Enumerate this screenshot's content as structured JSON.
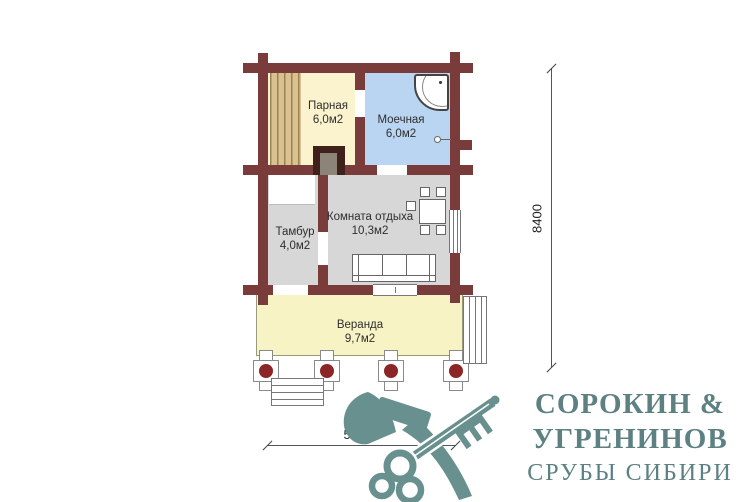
{
  "plan": {
    "rooms": [
      {
        "name": "Парная",
        "area": "6,0м2"
      },
      {
        "name": "Моечная",
        "area": "6,0м2"
      },
      {
        "name": "Тамбур",
        "area": "4,0м2"
      },
      {
        "name": "Комната отдыха",
        "area": "10,3м2"
      },
      {
        "name": "Веранда",
        "area": "9,7м2"
      }
    ],
    "dimensions": {
      "height_mm": "8400",
      "width_mm": "5300"
    },
    "features": [
      "sauna-bench",
      "stove",
      "shower-tray",
      "floor-drain",
      "table-with-chairs",
      "sofa",
      "window-east",
      "window-south",
      "veranda-columns",
      "steps-left",
      "steps-right"
    ],
    "colors": {
      "wall": "#7a3b3b",
      "parnaya_fill": "#fbf3cd",
      "moechnaya_fill": "#b9d5f1",
      "gray_room_fill": "#d7d7d7",
      "veranda_fill": "#f8f3c5",
      "bench": "#d9c28f",
      "column_dot": "#8c2525",
      "logo_teal": "#5d8083"
    }
  },
  "logo": {
    "line1": "СОРОКИН &",
    "line2": "УГРЕНИНОВ",
    "line3": "СРУБЫ СИБИРИ",
    "icon": "axe-and-key-icon"
  }
}
